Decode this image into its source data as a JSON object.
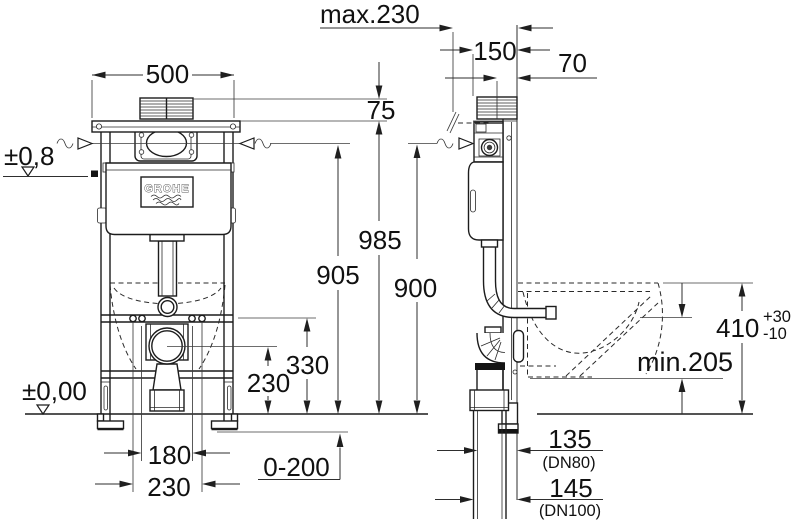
{
  "labels": {
    "brand": "GROHE",
    "front": {
      "width": "500",
      "level": "±0,8",
      "floor": "±0,00",
      "gap": "75",
      "total": "985",
      "inlet": "905",
      "bolt": "330",
      "drain": "230",
      "holes_inner": "180",
      "holes_outer": "230",
      "feet": "0-200"
    },
    "side": {
      "max_depth": "max.230",
      "depth": "150",
      "rod": "70",
      "inlet": "900",
      "rim": "410",
      "rim_plus": "+30",
      "rim_minus": "-10",
      "zone": "min.205",
      "out_a": "135",
      "out_a_dn": "(DN80)",
      "out_b": "145",
      "out_b_dn": "(DN100)"
    }
  }
}
